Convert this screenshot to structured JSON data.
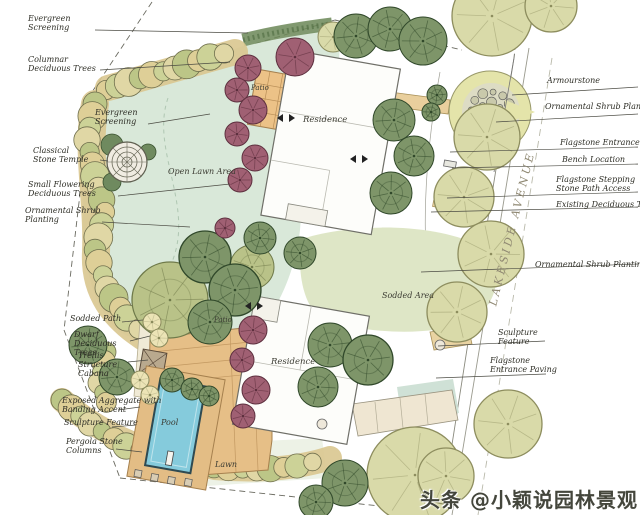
{
  "street": {
    "name": "LAKESIDE AVENUE"
  },
  "watermark": {
    "text": "头条 @小颖说园林景观"
  },
  "colors": {
    "paper": "#ffffff",
    "lawn": "#d9e8d9",
    "sodded_area": "#dee6c6",
    "bed_tan": "#decf97",
    "bed_olive": "#ccd297",
    "tree_dark_green": "#7e9569",
    "tree_plum": "#a06073",
    "tree_olive": "#d9daa9",
    "paving_tan": "#e6bf87",
    "pool_blue": "#85cbdc",
    "ink": "#3a3a30"
  },
  "annotations": {
    "left": [
      {
        "label": "Evergreen Screening"
      },
      {
        "label": "Columnar Deciduous Trees"
      },
      {
        "label": "Evergreen Screening"
      },
      {
        "label": "Classical Stone Temple"
      },
      {
        "label": "Small Flowering Deciduous Trees"
      },
      {
        "label": "Ornamental Shrub Planting"
      },
      {
        "label": "Sodded Path"
      },
      {
        "label": "Dwarf Deciduous Trees"
      },
      {
        "label": "Trellis Structure Cabana"
      },
      {
        "label": "Exposed Aggregate with Banding Accent"
      },
      {
        "label": "Sculpture Feature"
      },
      {
        "label": "Pergola Stone Columns"
      }
    ],
    "right": [
      {
        "label": "Armourstone"
      },
      {
        "label": "Ornamental Shrub Planting"
      },
      {
        "label": "Flagstone Entrance Paving"
      },
      {
        "label": "Bench Location"
      },
      {
        "label": "Flagstone Stepping Stone Path Access"
      },
      {
        "label": "Existing Deciduous Trees"
      },
      {
        "label": "Ornamental Shrub Planting"
      },
      {
        "label": "Sculpture Feature"
      },
      {
        "label": "Flagstone Entrance Paving"
      }
    ],
    "plan": [
      {
        "label": "Patio"
      },
      {
        "label": "Residence"
      },
      {
        "label": "Open Lawn Area"
      },
      {
        "label": "Sodded Area"
      },
      {
        "label": "Patio"
      },
      {
        "label": "Residence"
      },
      {
        "label": "Pool"
      },
      {
        "label": "Lawn"
      }
    ]
  }
}
